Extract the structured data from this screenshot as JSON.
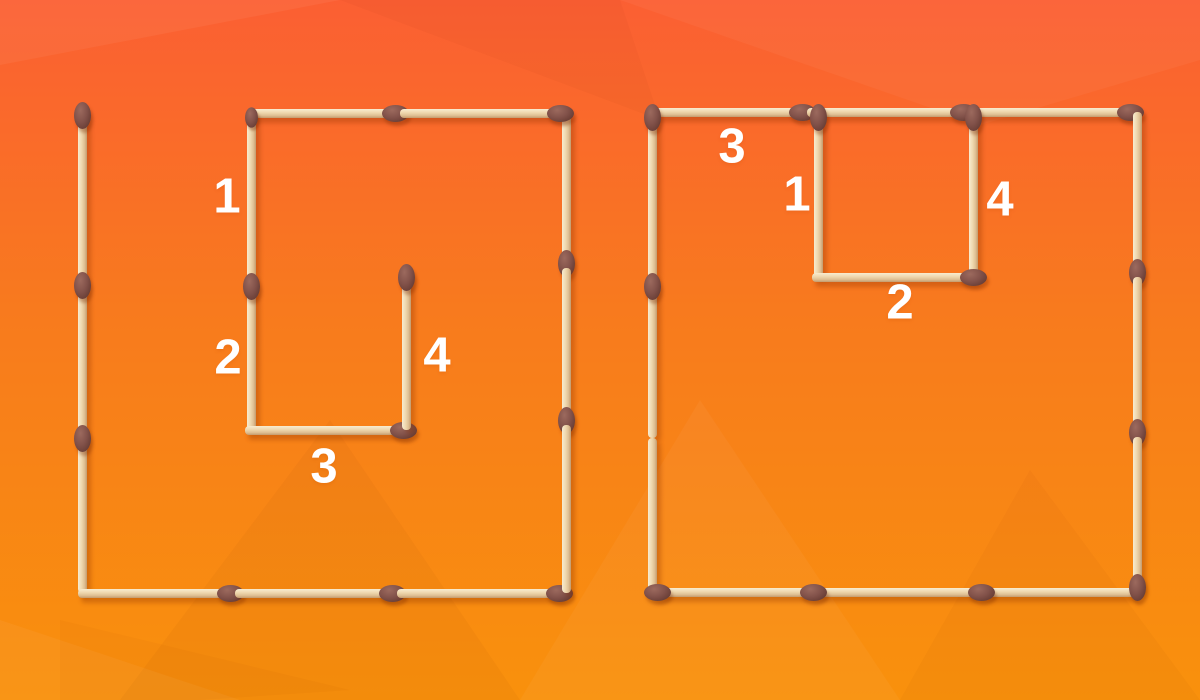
{
  "background": {
    "gradient_top": "#fb5f33",
    "gradient_mid": "#f87b1d",
    "gradient_bottom": "#f9910c"
  },
  "matchstick_colors": {
    "wood_light": "#f8ecd0",
    "wood_mid": "#eed7ad",
    "wood_shade": "#dfc094",
    "wood_dark": "#c39b6d",
    "head_light": "#9c6a5e",
    "head_mid": "#82524a",
    "head_dark": "#6b4038",
    "head_deep": "#59332c"
  },
  "label_color": "#ffffff",
  "figures": [
    {
      "name": "left-figure",
      "matches": [
        {
          "name": "outer-left-1",
          "x": 82,
          "y": 110,
          "dir": "v",
          "len": 170,
          "head": "start"
        },
        {
          "name": "outer-left-2",
          "x": 82,
          "y": 280,
          "dir": "v",
          "len": 153,
          "head": "start"
        },
        {
          "name": "outer-left-3",
          "x": 82,
          "y": 433,
          "dir": "v",
          "len": 160,
          "head": "start"
        },
        {
          "name": "outer-bottom-1",
          "x": 78,
          "y": 593,
          "dir": "h",
          "len": 157,
          "head": "end"
        },
        {
          "name": "outer-bottom-2",
          "x": 235,
          "y": 593,
          "dir": "h",
          "len": 162,
          "head": "end"
        },
        {
          "name": "outer-bottom-3",
          "x": 397,
          "y": 593,
          "dir": "h",
          "len": 167,
          "head": "end"
        },
        {
          "name": "outer-right-1",
          "x": 566,
          "y": 114,
          "dir": "v",
          "len": 154,
          "head": "end"
        },
        {
          "name": "outer-right-2",
          "x": 566,
          "y": 268,
          "dir": "v",
          "len": 157,
          "head": "end"
        },
        {
          "name": "outer-right-3",
          "x": 566,
          "y": 425,
          "dir": "v",
          "len": 168,
          "head": "none"
        },
        {
          "name": "outer-top-1",
          "x": 247,
          "y": 113,
          "dir": "h",
          "len": 153,
          "head": "end"
        },
        {
          "name": "outer-top-2",
          "x": 400,
          "y": 113,
          "dir": "h",
          "len": 165,
          "head": "end"
        },
        {
          "name": "match-1",
          "x": 251,
          "y": 112,
          "dir": "v",
          "len": 169,
          "head": "start",
          "small": true
        },
        {
          "name": "match-2",
          "x": 251,
          "y": 281,
          "dir": "v",
          "len": 149,
          "head": "start"
        },
        {
          "name": "match-3",
          "x": 245,
          "y": 430,
          "dir": "h",
          "len": 163,
          "head": "end"
        },
        {
          "name": "match-4",
          "x": 406,
          "y": 272,
          "dir": "v",
          "len": 158,
          "head": "start"
        }
      ],
      "labels": [
        {
          "text": "1",
          "x": 227,
          "y": 197
        },
        {
          "text": "2",
          "x": 228,
          "y": 358
        },
        {
          "text": "3",
          "x": 324,
          "y": 467
        },
        {
          "text": "4",
          "x": 437,
          "y": 356
        }
      ]
    },
    {
      "name": "right-figure",
      "matches": [
        {
          "name": "match-3",
          "x": 650,
          "y": 112,
          "dir": "h",
          "len": 157,
          "head": "end"
        },
        {
          "name": "outer-top-2",
          "x": 807,
          "y": 112,
          "dir": "h",
          "len": 161,
          "head": "end"
        },
        {
          "name": "outer-top-3",
          "x": 968,
          "y": 112,
          "dir": "h",
          "len": 167,
          "head": "end"
        },
        {
          "name": "outer-left-1",
          "x": 652,
          "y": 112,
          "dir": "v",
          "len": 169,
          "head": "start"
        },
        {
          "name": "outer-left-2",
          "x": 652,
          "y": 281,
          "dir": "v",
          "len": 157,
          "head": "start"
        },
        {
          "name": "outer-left-3",
          "x": 652,
          "y": 438,
          "dir": "v",
          "len": 154,
          "head": "none"
        },
        {
          "name": "outer-bottom-1",
          "x": 652,
          "y": 592,
          "dir": "h",
          "len": 156,
          "head": "start"
        },
        {
          "name": "outer-bottom-2",
          "x": 808,
          "y": 592,
          "dir": "h",
          "len": 168,
          "head": "start"
        },
        {
          "name": "outer-bottom-3",
          "x": 976,
          "y": 592,
          "dir": "h",
          "len": 161,
          "head": "start"
        },
        {
          "name": "outer-right-1",
          "x": 1137,
          "y": 112,
          "dir": "v",
          "len": 165,
          "head": "end"
        },
        {
          "name": "outer-right-2",
          "x": 1137,
          "y": 277,
          "dir": "v",
          "len": 160,
          "head": "end"
        },
        {
          "name": "outer-right-3",
          "x": 1137,
          "y": 437,
          "dir": "v",
          "len": 155,
          "head": "end"
        },
        {
          "name": "match-1",
          "x": 818,
          "y": 112,
          "dir": "v",
          "len": 165,
          "head": "start"
        },
        {
          "name": "match-4",
          "x": 973,
          "y": 112,
          "dir": "v",
          "len": 165,
          "head": "start"
        },
        {
          "name": "match-2",
          "x": 812,
          "y": 277,
          "dir": "h",
          "len": 166,
          "head": "end"
        }
      ],
      "labels": [
        {
          "text": "3",
          "x": 732,
          "y": 147
        },
        {
          "text": "1",
          "x": 797,
          "y": 195
        },
        {
          "text": "4",
          "x": 1000,
          "y": 200
        },
        {
          "text": "2",
          "x": 900,
          "y": 303
        }
      ]
    }
  ]
}
